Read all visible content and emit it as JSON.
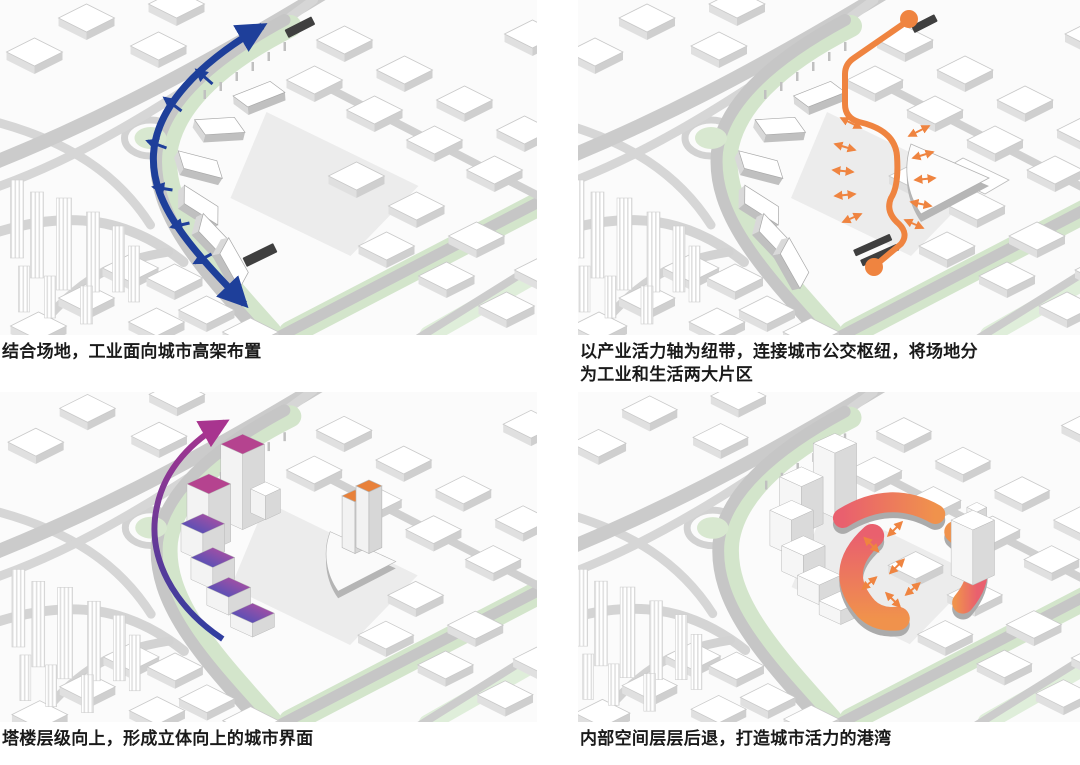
{
  "panels": [
    {
      "caption": "结合场地，工业面向城市高架布置"
    },
    {
      "caption": "以产业活力轴为纽带，连接城市公交枢纽，将场地分\n为工业和生活两大片区"
    },
    {
      "caption": "塔楼层级向上，形成立体向上的城市界面"
    },
    {
      "caption": "内部空间层层后退，打造城市活力的港湾"
    }
  ],
  "colors": {
    "flow-blue": "#1e3f9a",
    "axis-orange": "#ef8440",
    "rise-magenta": "#a8348f",
    "rise-deep-blue": "#2e3ea0",
    "roof-magenta": "#b5438f",
    "harbor-pink": "#e9606e",
    "harbor-orange": "#f0924c",
    "tower-top-orange": "#e8813a",
    "dark-slab": "#3f3f3f",
    "road-gray": "#c6c6c6",
    "green-strip": "#d3e5cb"
  }
}
